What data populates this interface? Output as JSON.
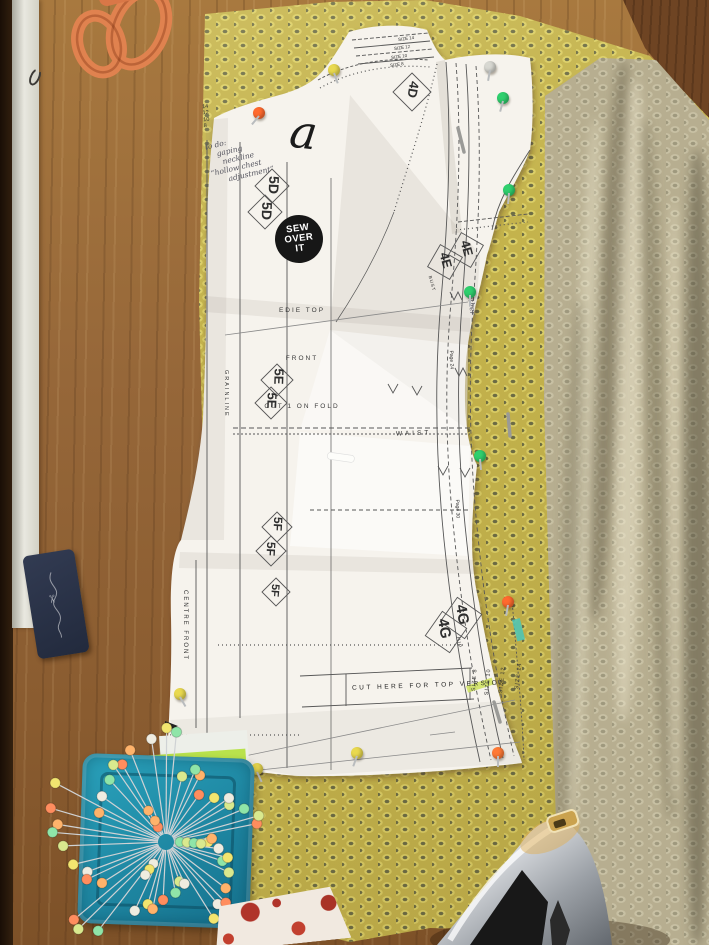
{
  "pattern_paper": {
    "annotation_letter": "a",
    "logo": [
      "SEW",
      "OVER",
      "IT"
    ],
    "piece_info": [
      "EDIE TOP",
      "FRONT",
      "CUT 1 ON FOLD"
    ],
    "cut_line_label": "CUT HERE FOR TOP VERSION",
    "waist_label": "WAIST",
    "bust_label": "BUST",
    "hip_label": "HIP",
    "centre_front_label": "CENTRE FRONT",
    "grainline_label": "GRAINLINE",
    "match_points": {
      "shoulder": "4D",
      "front_upper": "5D",
      "side_bust": "4E",
      "front_mid": "5E",
      "front_lower": "5F",
      "side_hip": "4G"
    },
    "page_refs": [
      "Page 24",
      "Page 30"
    ],
    "hem_sizes": [
      "SIZE 8",
      "SIZE 10",
      "SIZE 12",
      "SIZE 14"
    ],
    "shoulder_sizes": [
      "SIZE 14",
      "SIZE 12",
      "SIZE 10",
      "SIZE 8"
    ],
    "size_ticks": [
      "14",
      "12",
      "10",
      "8"
    ],
    "handwritten_notes": {
      "todo": [
        "to do:",
        "gaping",
        "neckline",
        "“hollow chest",
        "adjustment”"
      ],
      "gather": "gather"
    }
  },
  "tag": {
    "glyph": "✂"
  },
  "palette": {
    "fabric_front": "#c4b34c",
    "fabric_drape": "#b7ae90",
    "paper": "#f6f3ed",
    "wood": "#95663a",
    "tray_teal": "#1d8aa5",
    "scissors_orange": "#e0824f",
    "tag_navy": "#2b3347",
    "iron_silver": "#c7cad0",
    "highlight_green": "#cfe35c",
    "highlight_teal": "#49c6b8",
    "pin_colors": [
      "#f2e56f",
      "#ff8d5e",
      "#8fe5a8",
      "#efece0",
      "#ffb36b",
      "#d9e98e"
    ]
  },
  "pins": {
    "on_pattern": [
      {
        "c": "#ff6a2e",
        "x": 253,
        "y": 107,
        "r": 40
      },
      {
        "c": "#e9d94f",
        "x": 328,
        "y": 64,
        "r": -20
      },
      {
        "c": "#d8d8d2",
        "x": 484,
        "y": 61,
        "r": 10
      },
      {
        "c": "#2fd06e",
        "x": 497,
        "y": 92,
        "r": 15
      },
      {
        "c": "#2fd06e",
        "x": 503,
        "y": 184,
        "r": 5
      },
      {
        "c": "#2fd06e",
        "x": 464,
        "y": 286,
        "r": 0
      },
      {
        "c": "#2fd06e",
        "x": 474,
        "y": 450,
        "r": -5
      },
      {
        "c": "#ff6a2e",
        "x": 502,
        "y": 596,
        "r": 10
      },
      {
        "c": "#e9d94f",
        "x": 174,
        "y": 688,
        "r": -30
      },
      {
        "c": "#e9d94f",
        "x": 251,
        "y": 763,
        "r": -25
      },
      {
        "c": "#e9d94f",
        "x": 351,
        "y": 747,
        "r": 20
      },
      {
        "c": "#ff7a35",
        "x": 492,
        "y": 747,
        "r": 0
      }
    ]
  }
}
